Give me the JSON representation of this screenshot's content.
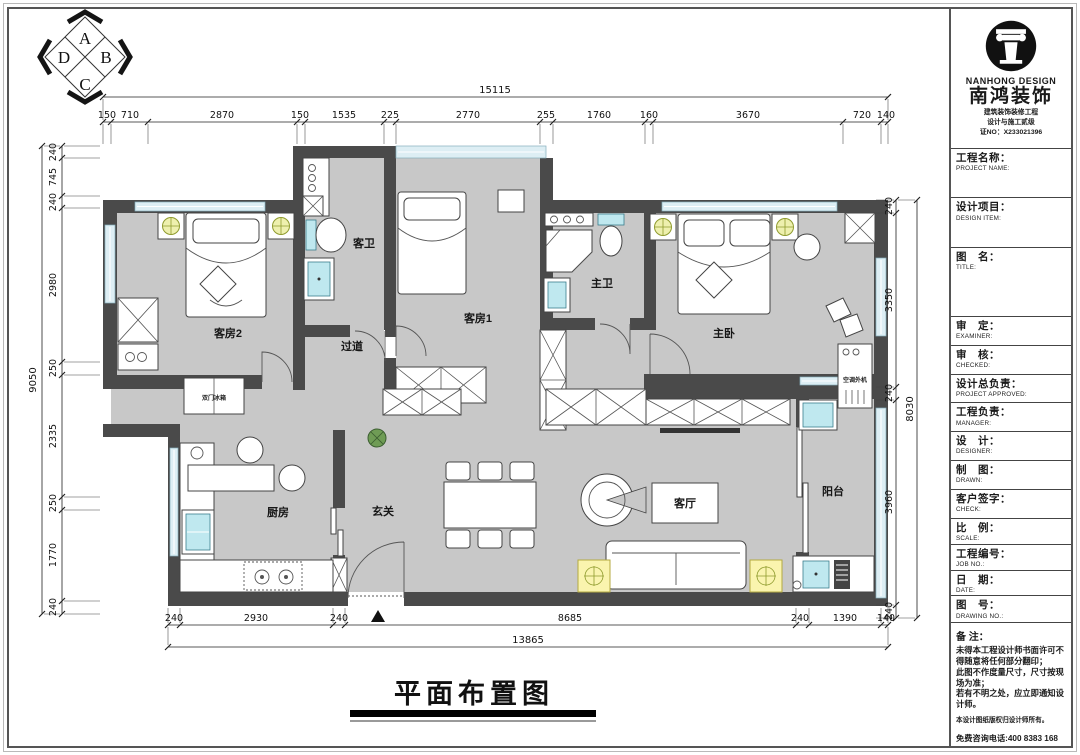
{
  "compass": {
    "a": "A",
    "b": "B",
    "c": "C",
    "d": "D"
  },
  "plan": {
    "title": "平面布置图",
    "rooms": {
      "bedroom2": "客房2",
      "guest_bath": "客卫",
      "corridor": "过道",
      "bedroom1": "客房1",
      "master_bath": "主卫",
      "master_bedroom": "主卧",
      "kitchen": "厨房",
      "entry": "玄关",
      "living": "客厅",
      "balcony": "阳台",
      "ac_unit": "空调外机",
      "fridge": "双门冰箱"
    }
  },
  "dims": {
    "top_total": "15115",
    "top": [
      "150",
      "710",
      "2870",
      "150",
      "1535",
      "225",
      "2770",
      "255",
      "1760",
      "160",
      "3670",
      "720",
      "140"
    ],
    "left_total": "9050",
    "left": [
      "240",
      "745",
      "240",
      "2980",
      "250",
      "2335",
      "250",
      "1770",
      "240"
    ],
    "right_total": "8030",
    "right": [
      "240",
      "3350",
      "240",
      "3960",
      "240"
    ],
    "bottom_total": "13865",
    "bottom": [
      "240",
      "2930",
      "240",
      "8685",
      "240",
      "1390",
      "140"
    ]
  },
  "title_block": {
    "company_en": "NANHONG DESIGN",
    "company_zh": "南鸿装饰",
    "cert_line1": "建筑装饰装修工程",
    "cert_line2": "设计与施工贰级",
    "cert_no": "证NO：X233021396",
    "fields": [
      {
        "zh": "工程名称：",
        "en": "PROJECT NAME:"
      },
      {
        "zh": "设计项目：",
        "en": "DESIGN ITEM:"
      },
      {
        "zh": "图　名：",
        "en": "TITLE:"
      },
      {
        "zh": "审　定：",
        "en": "EXAMINER:"
      },
      {
        "zh": "审　核：",
        "en": "CHECKED:"
      },
      {
        "zh": "设计总负责：",
        "en": "PROJECT APPROVED:"
      },
      {
        "zh": "工程负责：",
        "en": "MANAGER:"
      },
      {
        "zh": "设　计：",
        "en": "DESIGNER:"
      },
      {
        "zh": "制　图：",
        "en": "DRAWN:"
      },
      {
        "zh": "客户签字：",
        "en": "CHECK:"
      },
      {
        "zh": "比　例：",
        "en": "SCALE:"
      },
      {
        "zh": "工程编号：",
        "en": "JOB NO.:"
      },
      {
        "zh": "日　期：",
        "en": "DATE:"
      },
      {
        "zh": "图　号：",
        "en": "DRAWING NO.:"
      }
    ],
    "notes_label": "备 注：",
    "notes": [
      "未得本工程设计师书面许可不得随意将任何部分翻印；",
      "此图不作度量尺寸，尺寸按现场为准；",
      "若有不明之处，应立即通知设计师。"
    ],
    "copyright": "本设计图纸版权归设计师所有。",
    "hotline": "免费咨询电话:400 8383 168"
  }
}
